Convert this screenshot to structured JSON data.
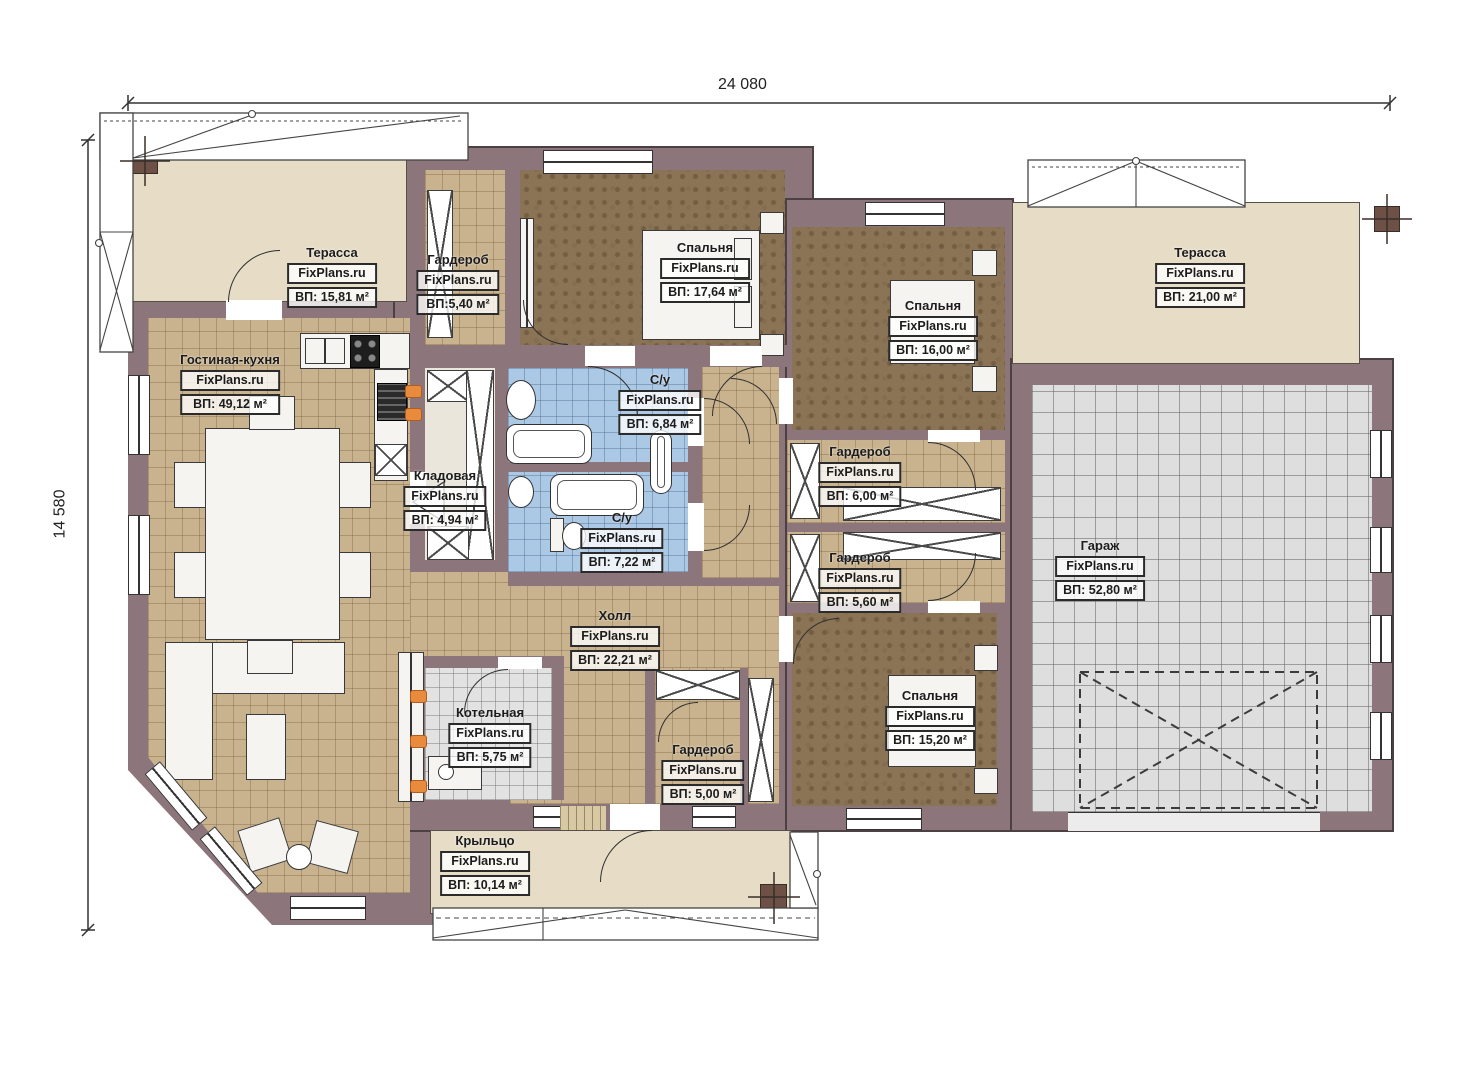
{
  "watermark": "FixPlans.ru",
  "dimensions": {
    "width": "24 080",
    "height": "14 580"
  },
  "rooms": [
    {
      "id": "terrace-left",
      "name": "Терасса",
      "area": "ВП: 15,81 м²"
    },
    {
      "id": "wardrobe-top",
      "name": "Гардероб",
      "area": "ВП:5,40 м²"
    },
    {
      "id": "bedroom-1",
      "name": "Спальня",
      "area": "ВП: 17,64 м²"
    },
    {
      "id": "bedroom-2",
      "name": "Спальня",
      "area": "ВП: 16,00 м²"
    },
    {
      "id": "terrace-right",
      "name": "Терасса",
      "area": "ВП: 21,00 м²"
    },
    {
      "id": "living-kitchen",
      "name": "Гостиная-кухня",
      "area": "ВП: 49,12 м²"
    },
    {
      "id": "bath-1",
      "name": "С/у",
      "area": "ВП: 6,84 м²"
    },
    {
      "id": "pantry",
      "name": "Кладовая",
      "area": "ВП: 4,94 м²"
    },
    {
      "id": "bath-2",
      "name": "С/у",
      "area": "ВП: 7,22 м²"
    },
    {
      "id": "wardrobe-600",
      "name": "Гардероб",
      "area": "ВП: 6,00 м²"
    },
    {
      "id": "wardrobe-560",
      "name": "Гардероб",
      "area": "ВП: 5,60 м²"
    },
    {
      "id": "garage",
      "name": "Гараж",
      "area": "ВП: 52,80 м²"
    },
    {
      "id": "hall",
      "name": "Холл",
      "area": "ВП: 22,21 м²"
    },
    {
      "id": "boiler",
      "name": "Котельная",
      "area": "ВП: 5,75 м²"
    },
    {
      "id": "wardrobe-500",
      "name": "Гардероб",
      "area": "ВП: 5,00 м²"
    },
    {
      "id": "bedroom-3",
      "name": "Спальня",
      "area": "ВП: 15,20 м²"
    },
    {
      "id": "porch",
      "name": "Крыльцо",
      "area": "ВП: 10,14 м²"
    }
  ]
}
